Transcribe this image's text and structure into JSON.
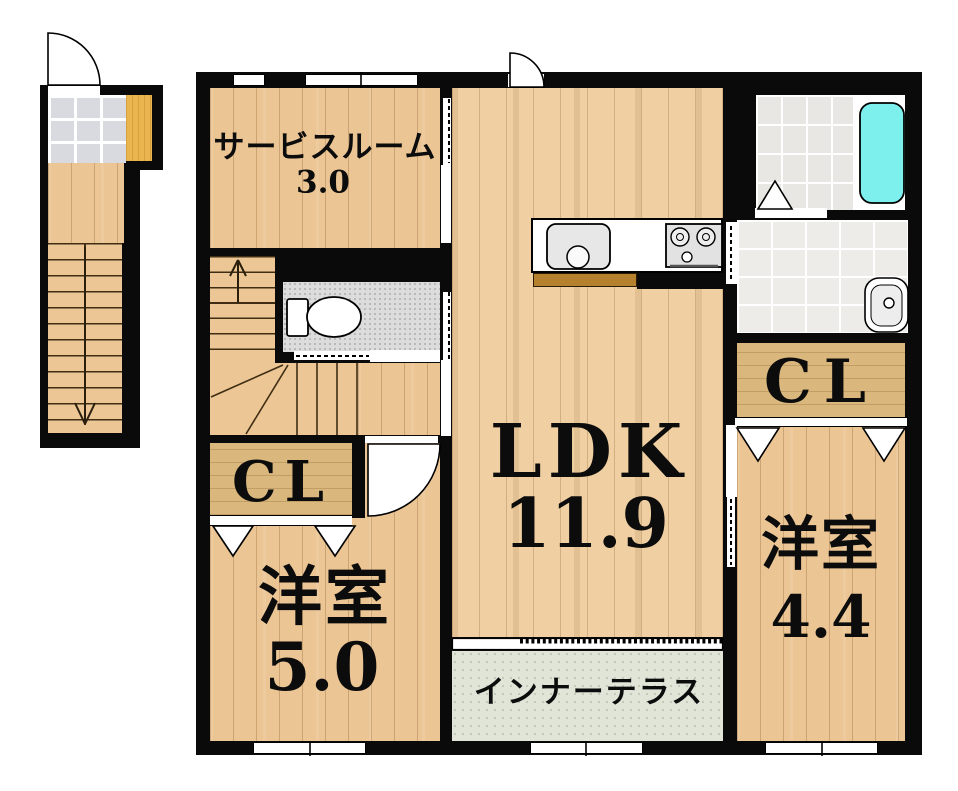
{
  "rooms": {
    "service": {
      "name": "サービスルーム",
      "area": "3.0"
    },
    "ldk": {
      "name": "LDK",
      "area": "11.9"
    },
    "bedroom_left": {
      "name": "洋室",
      "area": "5.0"
    },
    "bedroom_right": {
      "name": "洋室",
      "area": "4.4"
    },
    "terrace": {
      "name": "インナーテラス"
    },
    "closet_left": {
      "name": "CL"
    },
    "closet_right": {
      "name": "CL"
    }
  },
  "fixtures": [
    "toilet",
    "bathtub",
    "kitchen-sink",
    "gas-stove",
    "washbasin",
    "stairs-up-arrow",
    "stairs-down-arrow",
    "swing-doors",
    "sliding-doors",
    "folding-door",
    "closet-doors",
    "windows"
  ],
  "colors": {
    "wall": "#0a0a0a",
    "wood_floor": "#ebc594",
    "ldk_floor": "#f0d0a2",
    "closet_floor": "#dab77c",
    "terrace_floor": "#e0e5d8",
    "bathtub": "#7df0ee",
    "entrance_mat": "#e9b54f",
    "bath_tile": "#e8e7e3",
    "toilet_floor": "#dcdcdc",
    "entrance_tile": "#d9dadf",
    "counter_edge": "#b5812f"
  }
}
